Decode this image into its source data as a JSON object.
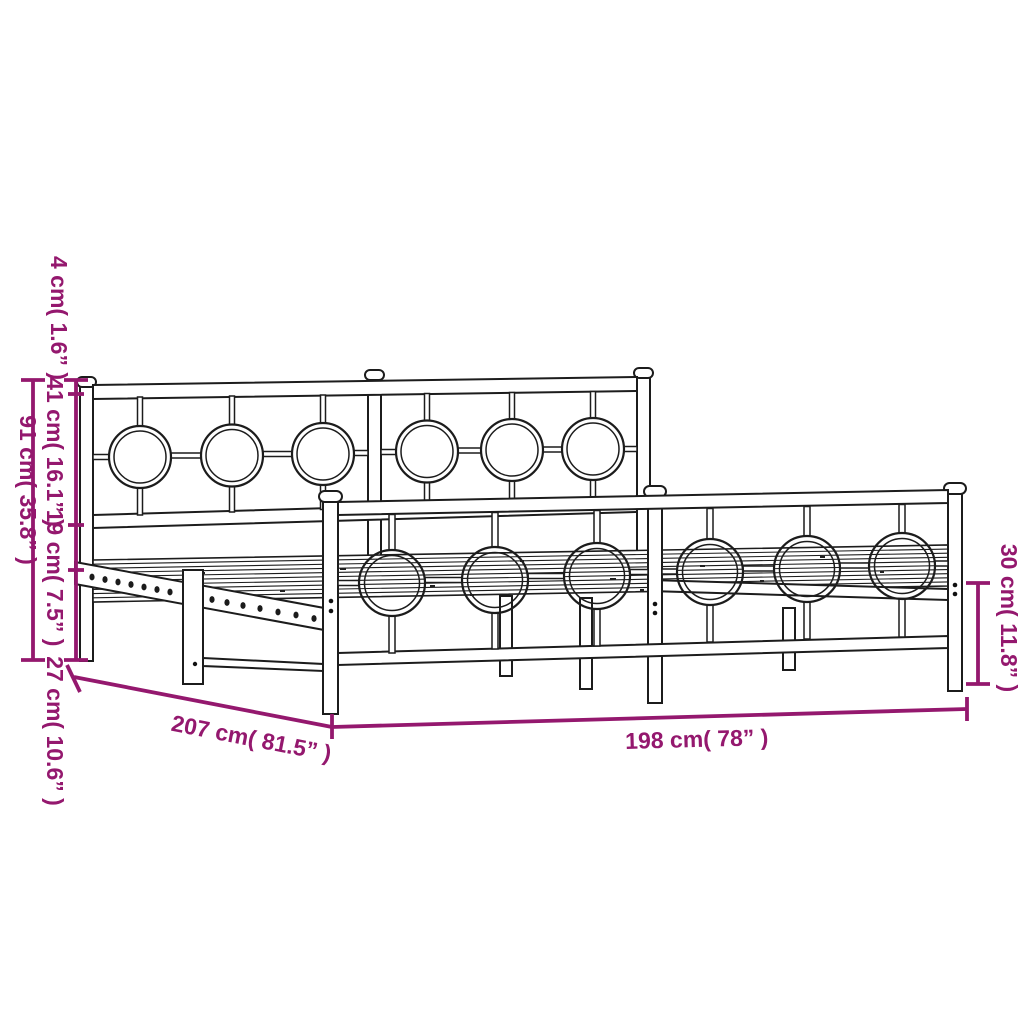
{
  "diagram": {
    "type": "product-dimension-diagram",
    "subject": "metal bed frame with headboard and footboard",
    "background_color": "#ffffff",
    "outline_color": "#1c1c1c",
    "dimension_color": "#94186E"
  },
  "dims": {
    "d4": {
      "label": "4 cm( 1.6” )",
      "cm": 4,
      "inch": 1.6
    },
    "d41": {
      "label": "41 cm( 16.1” )",
      "cm": 41,
      "inch": 16.1
    },
    "d91": {
      "label": "91 cm( 35.8” )",
      "cm": 91,
      "inch": 35.8
    },
    "d19": {
      "label": "19 cm( 7.5” )",
      "cm": 19,
      "inch": 7.5
    },
    "d27": {
      "label": "27 cm( 10.6” )",
      "cm": 27,
      "inch": 10.6
    },
    "d30": {
      "label": "30 cm( 11.8” )",
      "cm": 30,
      "inch": 11.8
    },
    "d207": {
      "label": "207 cm( 81.5” )",
      "cm": 207,
      "inch": 81.5
    },
    "d198": {
      "label": "198 cm( 78” )",
      "cm": 198,
      "inch": 78
    }
  }
}
